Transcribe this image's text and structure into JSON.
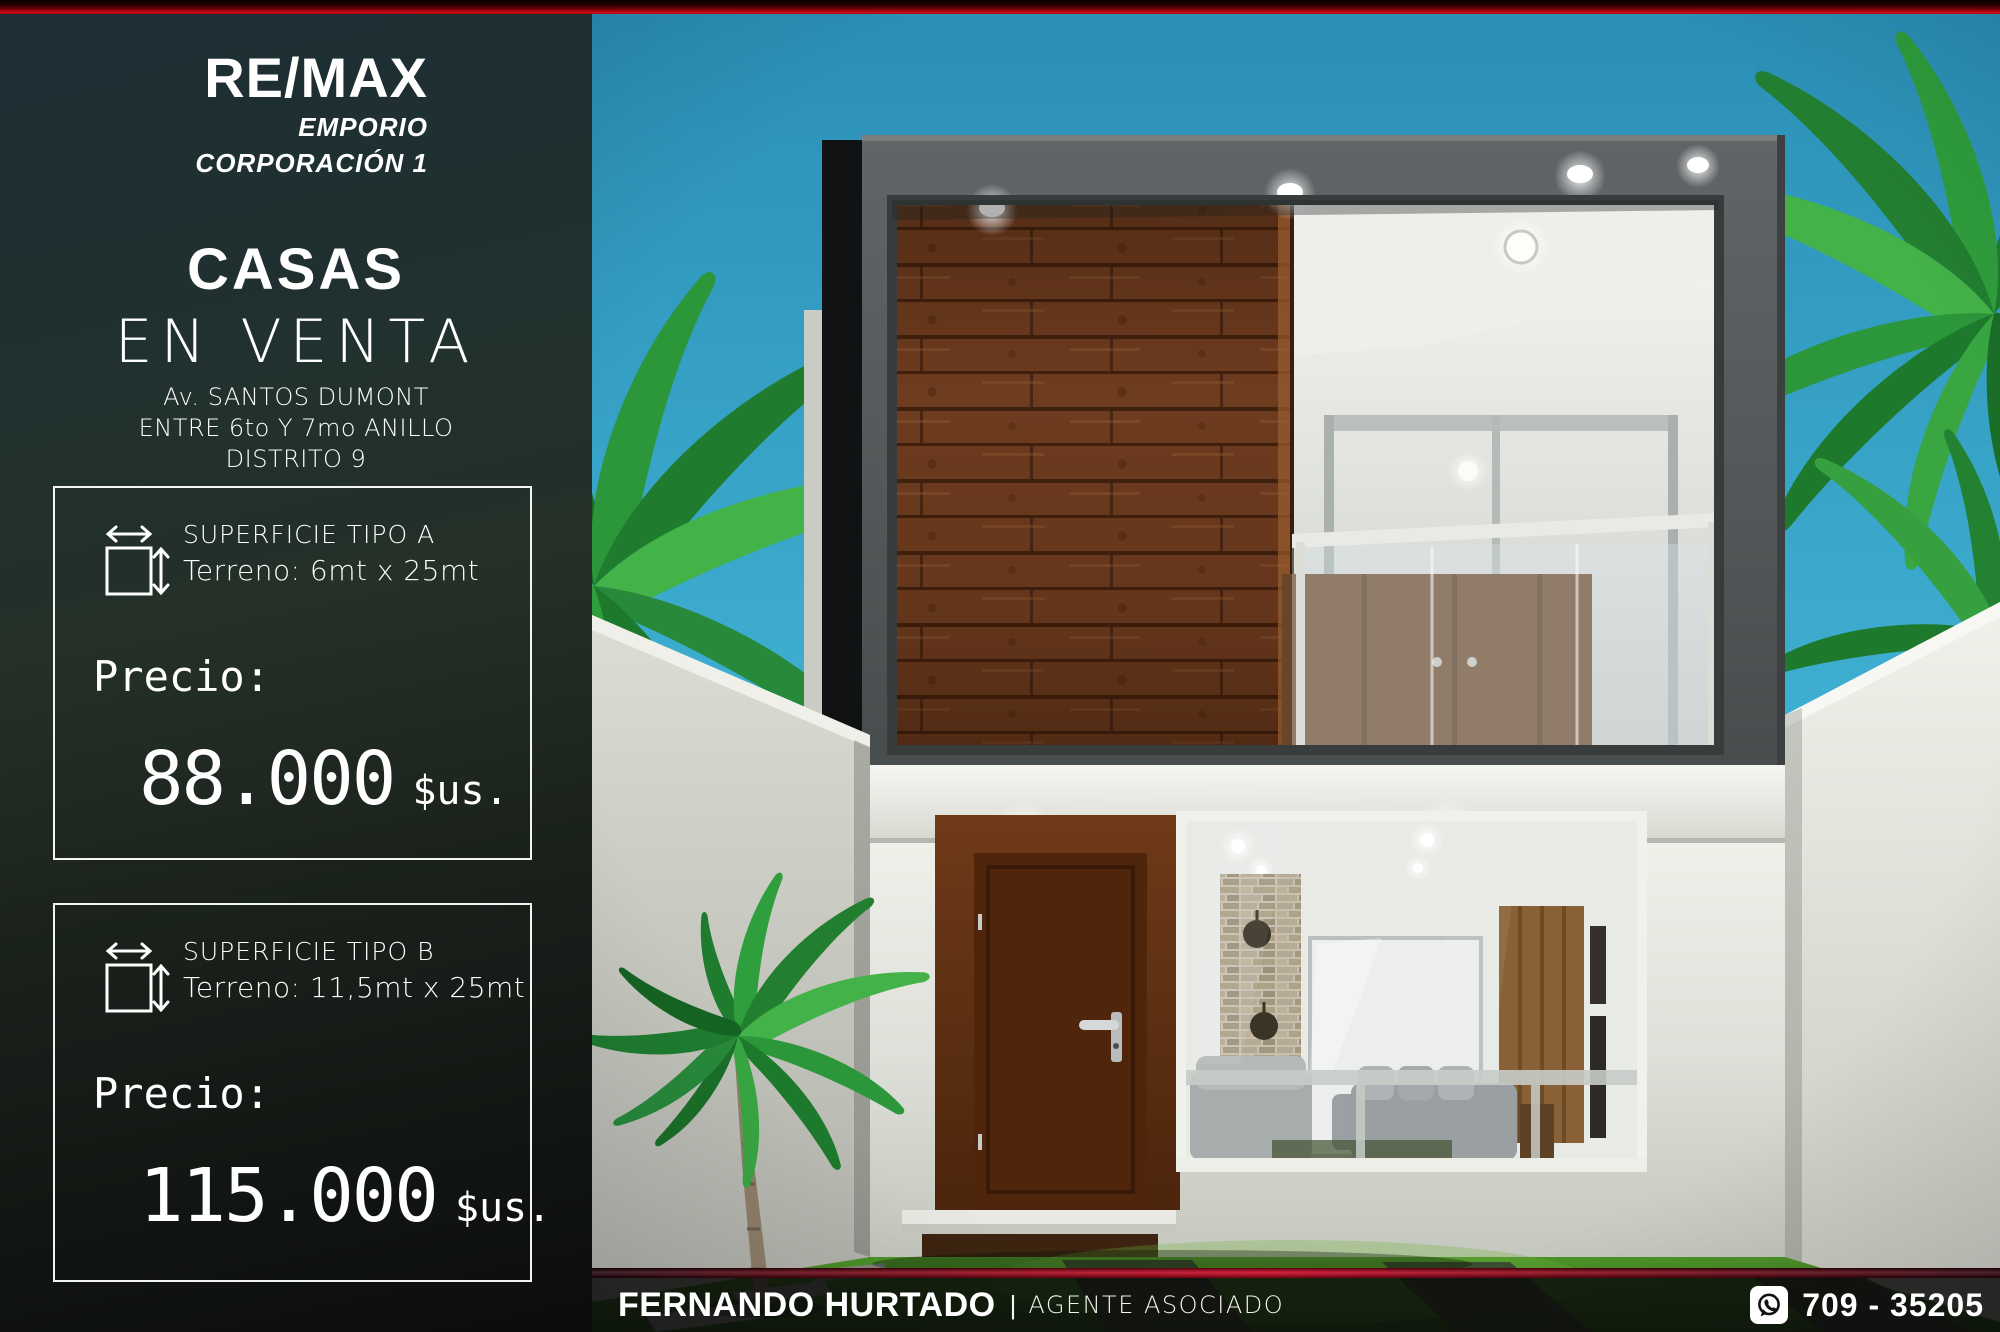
{
  "brand": {
    "name": "RE/MAX",
    "division_line1": "EMPORIO",
    "division_line2": "CORPORACIÓN 1"
  },
  "headline": {
    "line1": "CASAS",
    "line2": "EN VENTA"
  },
  "address": {
    "line1": "Av. SANTOS DUMONT",
    "line2": "ENTRE 6to Y 7mo ANILLO",
    "line3": "DISTRITO 9"
  },
  "offers": [
    {
      "surface": "SUPERFICIE TIPO A",
      "terrain": "Terreno: 6mt x 25mt",
      "price_label": "Precio:",
      "price": "88.000",
      "currency": "$us."
    },
    {
      "surface": "SUPERFICIE TIPO B",
      "terrain": "Terreno: 11,5mt x 25mt",
      "price_label": "Precio:",
      "price": "115.000",
      "currency": "$us."
    }
  ],
  "footer": {
    "agent": "FERNANDO HURTADO",
    "separator": "|",
    "role": "AGENTE ASOCIADO",
    "phone": "709 - 35205",
    "phone_icon": "whatsapp-icon"
  },
  "colors": {
    "accent_red": "#c2001e",
    "deep_red": "#3a0006",
    "panel_top": "#1d2e35",
    "panel_bottom": "#0b0d0b",
    "sky_blue": "#3fb0d2",
    "text": "#ffffff"
  }
}
